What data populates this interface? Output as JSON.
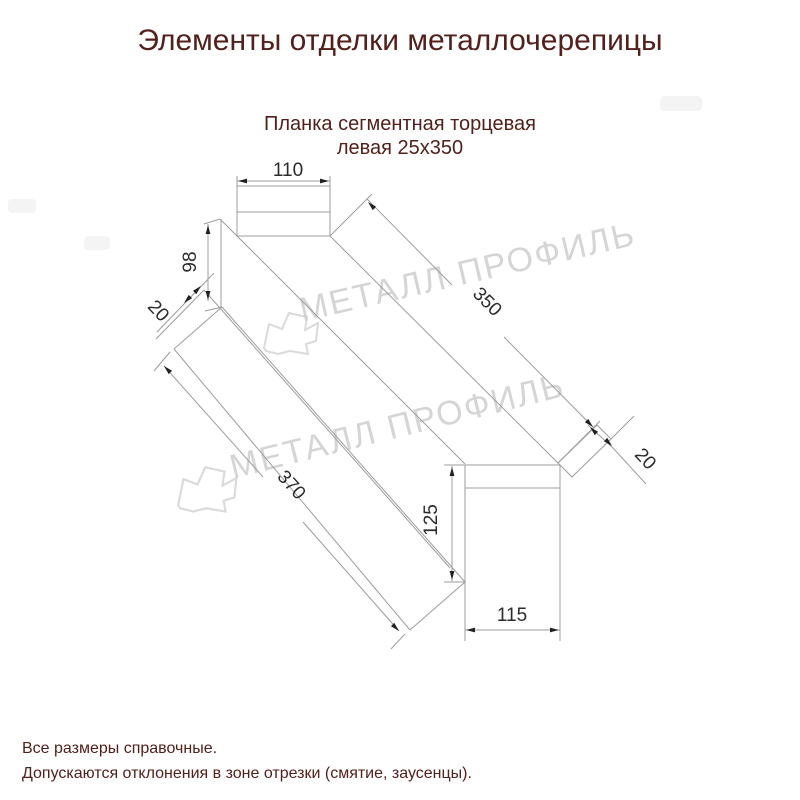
{
  "header": {
    "title": "Элементы отделки металлочерепицы"
  },
  "drawing": {
    "subtitle": {
      "line1": "Планка сегментная торцевая",
      "line2": "левая 25х350"
    },
    "dimensions": {
      "flange_width": "110",
      "end_height": "98",
      "hem_left": "20",
      "length_outer": "350",
      "length_inner": "370",
      "face_height": "125",
      "face_width": "115",
      "hem_right": "20"
    }
  },
  "watermark": {
    "text": "МЕТАЛЛ ПРОФИЛЬ"
  },
  "footer": {
    "line1": "Все размеры справочные.",
    "line2": "Допускаются отклонения в зоне отрезки (смятие, заусенцы)."
  },
  "colors": {
    "accent_text": "#53201b",
    "drawing_line": "#9d9d9d",
    "dim_text": "#2b2b2b",
    "watermark": "#cbcbcb"
  }
}
